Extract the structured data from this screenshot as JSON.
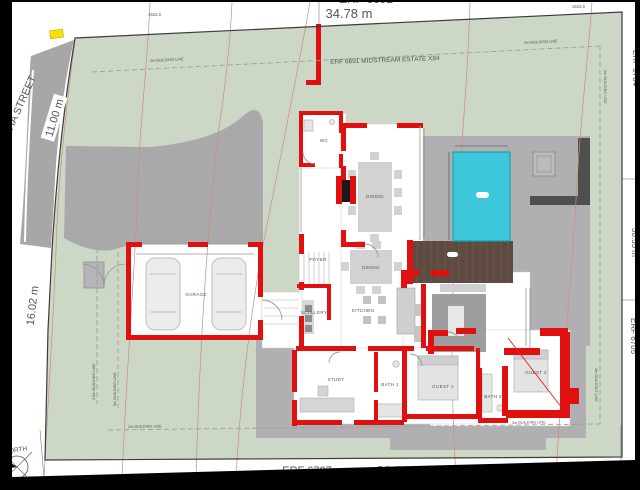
{
  "drawing": {
    "north_label": "NORTH",
    "street_name": "2 ANCHA STREET",
    "dims": {
      "top": "34.78 m",
      "street": "11.00 m",
      "west": "16.02 m",
      "east": "30.55 m",
      "south": "36.93 m"
    },
    "erven": {
      "top": "ERF 6692",
      "estate": "ERF 6691 MIDSTREAM ESTATE X84",
      "east": "ERF 6704",
      "southeast": "ERF 6705",
      "south": "ERF 6707"
    },
    "building_lines": {
      "two_m": "2m BUILDING LINE",
      "three_five_m": "3.5m BUILDING LINE",
      "five_m": "5m BUILDING LINE"
    },
    "contours": {
      "c1": "1522.8",
      "c2": "1522.6",
      "c3": "1522.5"
    },
    "rooms": {
      "garage": "GARAGE",
      "scullery": "SCULLERY",
      "foyer": "FOYER",
      "wc": "WC",
      "dining": "DINING",
      "dining2": "DINING",
      "kitchen": "KITCHEN",
      "study": "STUDY",
      "bath1": "BATH 1",
      "guest1": "GUEST 1",
      "bath2": "BATH 2",
      "guest2": "GUEST 2"
    },
    "colors": {
      "site_green": "#ccd7c5",
      "paving": "#b0b0b2",
      "road": "#a7a7a9",
      "wall_red": "#e01010",
      "pool": "#3cc7da",
      "deck": "#5d4a40",
      "marker_yellow": "#ffe100"
    }
  }
}
